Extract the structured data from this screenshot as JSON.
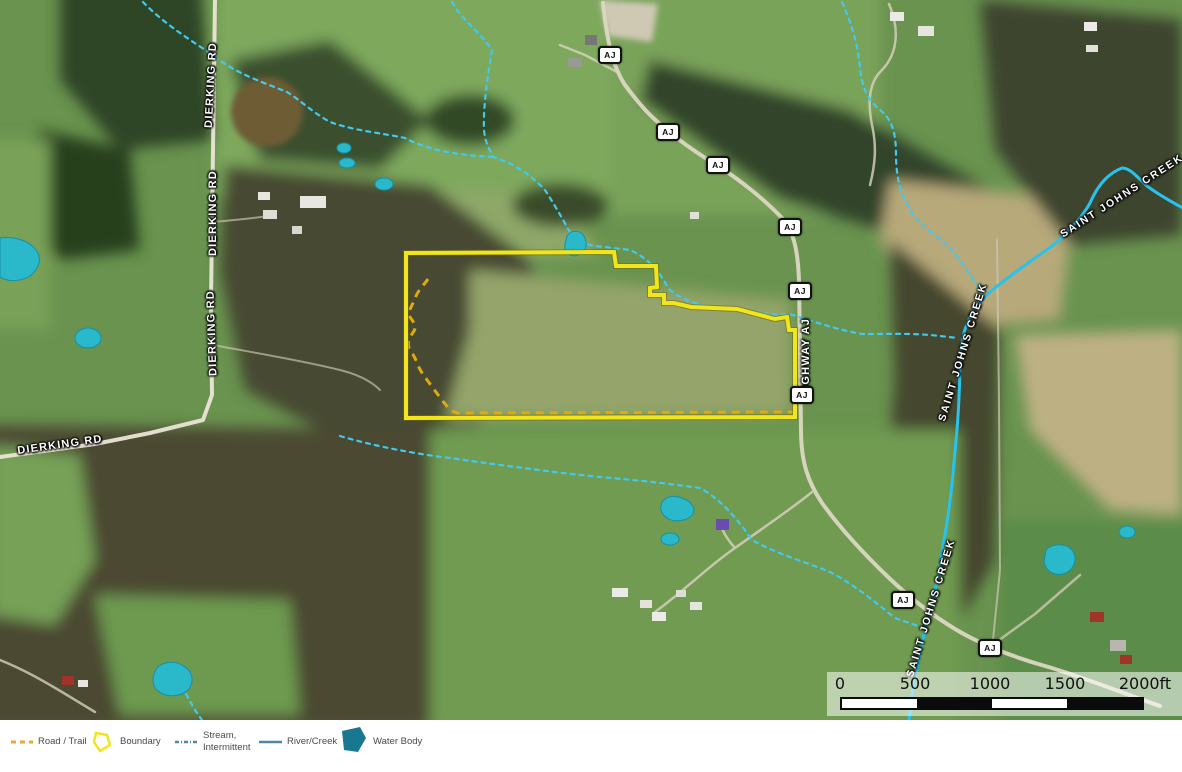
{
  "colors": {
    "boundary_yellow": "#F2E51C",
    "trail_gold": "#DFA90F",
    "legend_trail_orange": "#F0A43A",
    "stream_cyan": "#41C9F0",
    "river_cyan": "#27C2EE",
    "legend_stream_blue": "#4E87A8",
    "water_teal": "#2AB8CB",
    "legend_water_teal": "#17788F",
    "shield_background": "#FFFFFF",
    "map_label_white": "#FFFFFF"
  },
  "map": {
    "road_labels": [
      {
        "text": "DIERKING RD",
        "x": 211,
        "y": 85,
        "rot": -87,
        "cls": "road-label",
        "kind": "road-label-dierking"
      },
      {
        "text": "DIERKING RD",
        "x": 213,
        "y": 213,
        "rot": -90,
        "cls": "road-label",
        "kind": "road-label-dierking"
      },
      {
        "text": "DIERKING RD",
        "x": 212,
        "y": 333,
        "rot": -92,
        "cls": "road-label",
        "kind": "road-label-dierking"
      },
      {
        "text": "DIERKING RD",
        "x": 60,
        "y": 445,
        "rot": -8,
        "cls": "road-label",
        "kind": "road-label-dierking"
      },
      {
        "text": "HIGHWAY AJ",
        "x": 806,
        "y": 358,
        "rot": -90,
        "cls": "road-label",
        "kind": "road-label-highway-aj"
      },
      {
        "text": "SAINT JOHNS CREEK",
        "x": 1122,
        "y": 196,
        "rot": -33,
        "cls": "creek-label",
        "kind": "creek-label-saint-johns"
      },
      {
        "text": "SAINT JOHNS CREEK",
        "x": 963,
        "y": 352,
        "rot": -73,
        "cls": "creek-label",
        "kind": "creek-label-saint-johns"
      },
      {
        "text": "SAINT JOHNS CREEK",
        "x": 931,
        "y": 608,
        "rot": -73,
        "cls": "creek-label",
        "kind": "creek-label-saint-johns"
      }
    ],
    "highway_shields": [
      {
        "text": "AJ",
        "x": 610,
        "y": 55
      },
      {
        "text": "AJ",
        "x": 668,
        "y": 132
      },
      {
        "text": "AJ",
        "x": 718,
        "y": 165
      },
      {
        "text": "AJ",
        "x": 790,
        "y": 227
      },
      {
        "text": "AJ",
        "x": 800,
        "y": 291
      },
      {
        "text": "AJ",
        "x": 802,
        "y": 395
      },
      {
        "text": "AJ",
        "x": 903,
        "y": 600
      },
      {
        "text": "AJ",
        "x": 990,
        "y": 648
      }
    ],
    "scale_bar": {
      "labels": [
        "0",
        "500",
        "1000",
        "1500",
        "2000ft"
      ]
    }
  },
  "legend": {
    "items": [
      {
        "id": "road-trail",
        "label": "Road / Trail"
      },
      {
        "id": "boundary",
        "label": "Boundary"
      },
      {
        "id": "stream-intermittent",
        "label_line1": "Stream,",
        "label_line2": "Intermittent"
      },
      {
        "id": "river-creek",
        "label": "River/Creek"
      },
      {
        "id": "water-body",
        "label": "Water Body"
      }
    ]
  }
}
